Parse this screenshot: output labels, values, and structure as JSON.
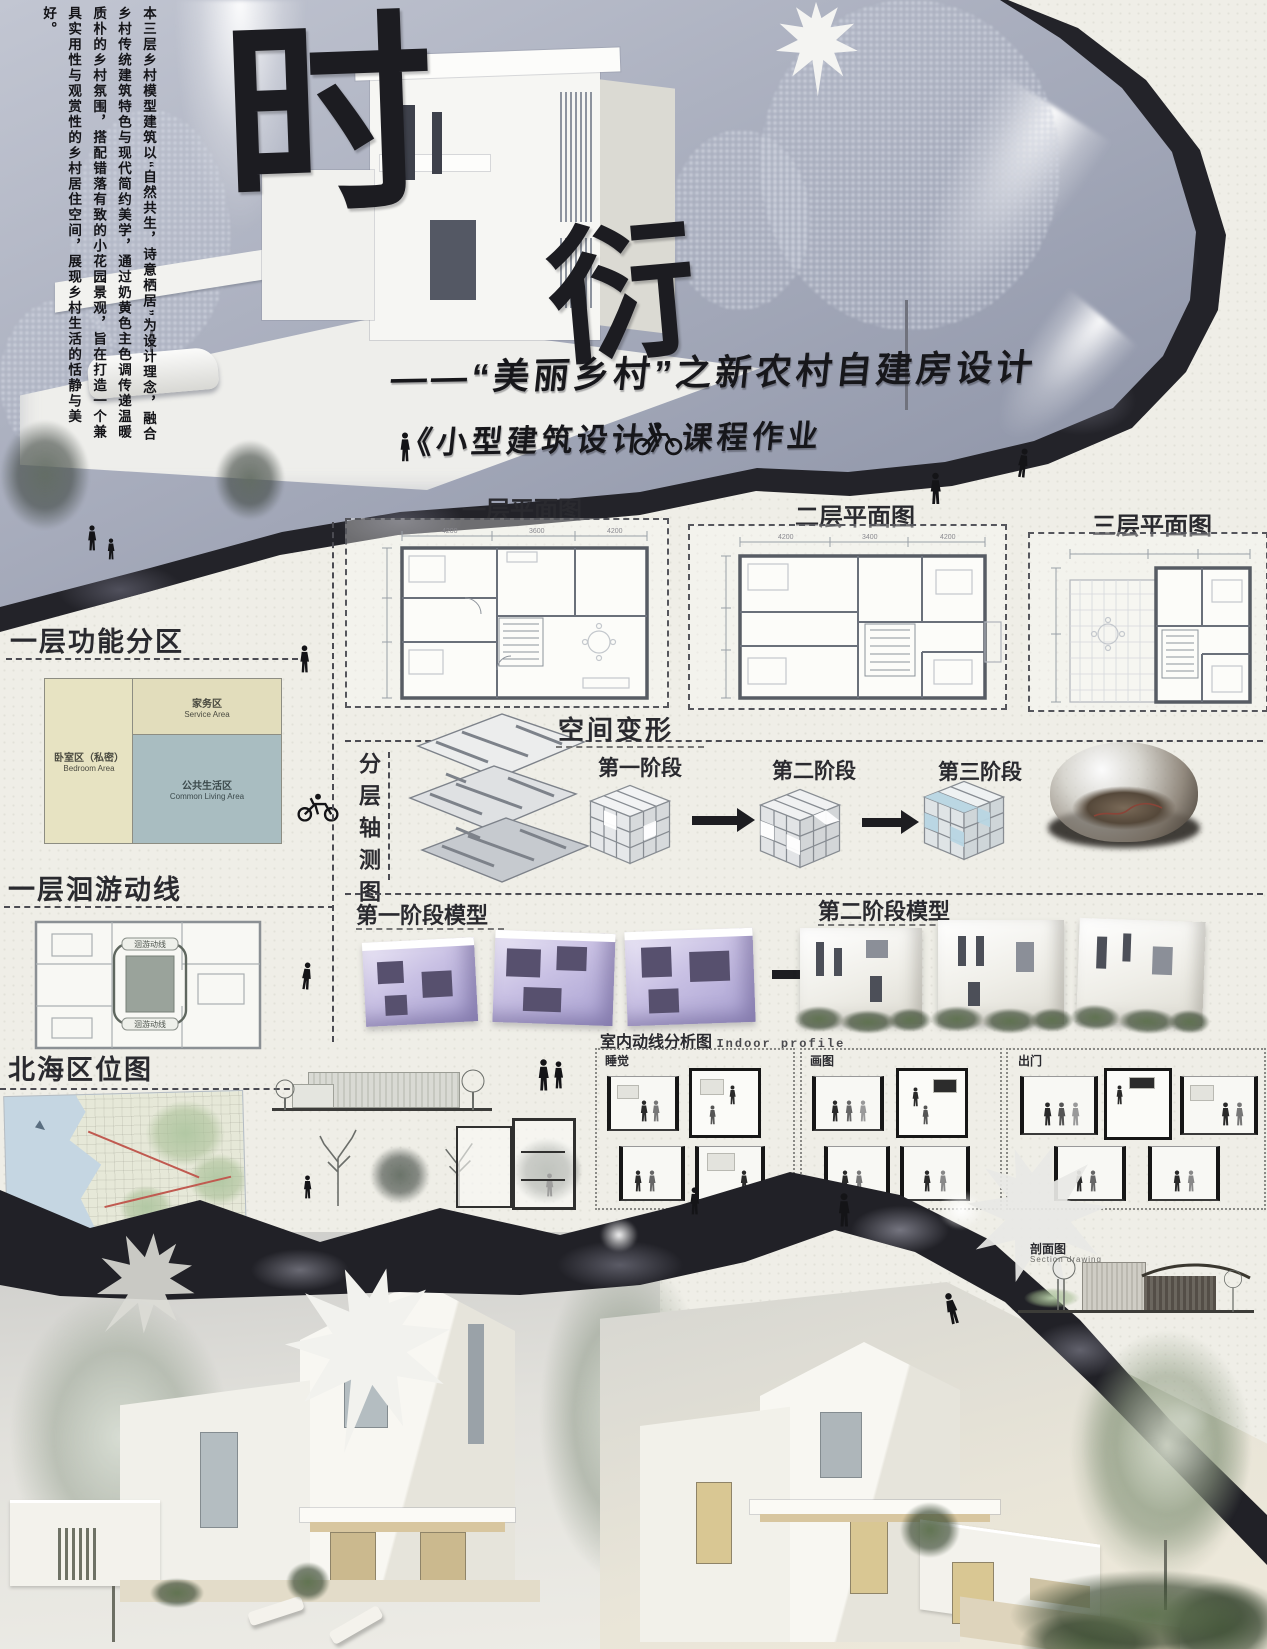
{
  "intro": {
    "text": "本三层乡村模型建筑以“自然共生，诗意栖居”为设计理念，融合乡村传统建筑特色与现代简约美学，通过奶黄色主色调传递温暖质朴的乡村氛围，搭配错落有致的小花园景观，旨在打造一个兼具实用性与观赏性的乡村居住空间，展现乡村生活的恬静与美好。"
  },
  "title": {
    "char1": "时",
    "char2": "衍",
    "subtitle1": "——“美丽乡村”之新农村自建房设计",
    "subtitle2": "《小型建筑设计》课程作业"
  },
  "plans": {
    "first": {
      "title": "一层平面图",
      "dims_top": [
        "4200",
        "3600",
        "4200"
      ]
    },
    "second": {
      "title": "二层平面图",
      "dims_top": [
        "4200",
        "3400",
        "4200"
      ]
    },
    "third": {
      "title": "三层平面图"
    }
  },
  "zoning": {
    "title": "一层功能分区",
    "service": {
      "zh": "家务区",
      "en": "Service Area"
    },
    "bedroom": {
      "zh": "卧室区（私密）",
      "en": "Bedroom Area"
    },
    "living": {
      "zh": "公共生活区",
      "en": "Common Living Area"
    }
  },
  "circulation": {
    "title": "一层洄游动线",
    "loop": "洄游动线"
  },
  "axon": {
    "label": "分层轴测图"
  },
  "transform": {
    "title": "空间变形",
    "stage1": "第一阶段",
    "stage2": "第二阶段",
    "stage3": "第三阶段"
  },
  "models": {
    "stage1": "第一阶段模型",
    "stage2": "第二阶段模型"
  },
  "location": {
    "title": "北海区位图"
  },
  "indoor": {
    "title": "室内动线分析图",
    "subtitle": "Indoor profile",
    "sleep": "睡觉",
    "draw": "画图",
    "out": "出门"
  },
  "section_drawing": {
    "zh": "剖面图",
    "en": "Section drawing"
  },
  "colors": {
    "accent_dark": "#1d1d22",
    "zoning_beige": "#e4e0bf",
    "zoning_blue": "#a9bdc1",
    "model_purple": "#b7aed6",
    "hero_sky": "#a7acbc",
    "rock": "#232329"
  }
}
